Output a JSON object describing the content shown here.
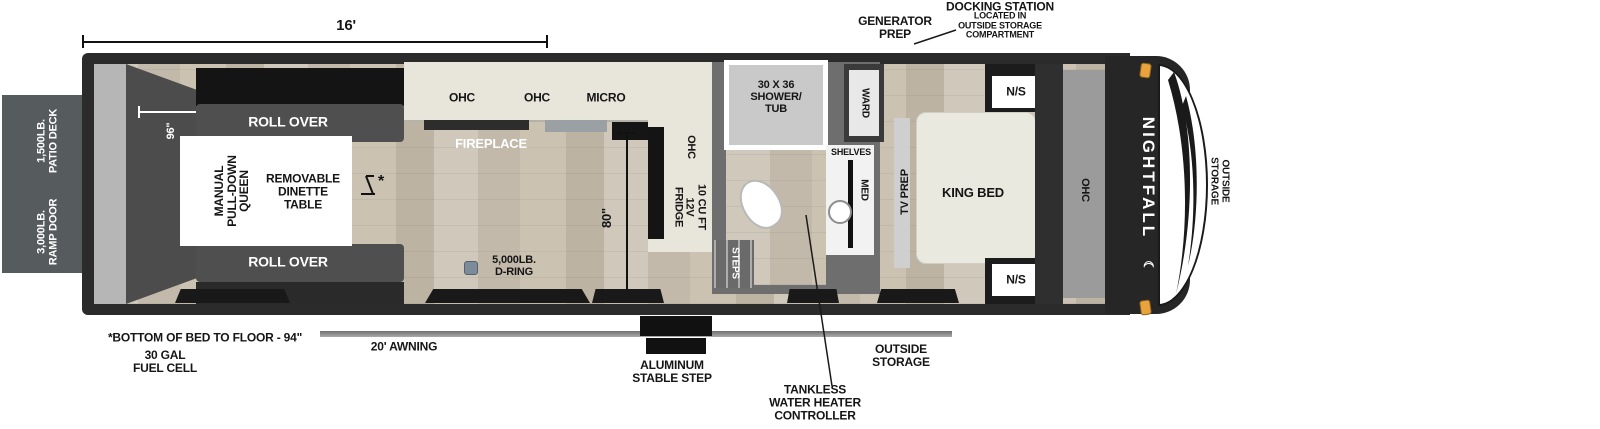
{
  "overall_dim": "16'",
  "exterior_left": {
    "patio_deck": "1,500LB.\nPATIO DECK",
    "ramp_door": "3,000LB.\nRAMP DOOR"
  },
  "garage": {
    "width_dim": "96\"",
    "sofa_top": "ROLL OVER",
    "sofa_bottom": "ROLL OVER",
    "queen_bed": "MANUAL\nPULL-DOWN\nQUEEN",
    "dinette": "REMOVABLE\nDINETTE\nTABLE",
    "table_mark": "*"
  },
  "kitchen": {
    "ohc_left": "OHC",
    "ohc_mid": "OHC",
    "micro": "MICRO",
    "fireplace": "FIREPLACE",
    "ohc_side": "OHC",
    "fridge": "10 CU FT\n12V\nFRIDGE",
    "height_dim": "80\"",
    "d_ring": "5,000LB.\nD-RING"
  },
  "bathroom": {
    "shower": "30 X 36\nSHOWER/\nTUB",
    "shelves": "SHELVES",
    "med": "MED",
    "ward": "WARD",
    "steps": "STEPS"
  },
  "bedroom": {
    "king_bed": "KING BED",
    "tv_prep": "TV PREP",
    "ns_top": "N/S",
    "ns_bottom": "N/S",
    "ohc": "OHC"
  },
  "front": {
    "brand": "NIGHTFALL",
    "crescent": "☾",
    "outside_storage": "OUTSIDE\nSTORAGE"
  },
  "callouts_top": {
    "generator_prep": "GENERATOR\nPREP",
    "docking_station": "DOCKING STATION",
    "docking_station_sub": "LOCATED IN\nOUTSIDE STORAGE\nCOMPARTMENT"
  },
  "callouts_bottom": {
    "bed_to_floor": "*BOTTOM OF BED TO FLOOR - 94\"",
    "fuel_cell": "30 GAL\nFUEL CELL",
    "awning": "20' AWNING",
    "stable_step": "ALUMINUM\nSTABLE STEP",
    "outside_storage": "OUTSIDE\nSTORAGE",
    "tankless": "TANKLESS\nWATER HEATER\nCONTROLLER"
  },
  "colors": {
    "body": "#2b2b2b",
    "counter": "#e8e5da",
    "floor": "#cbc3b6",
    "deck": "#565b5e",
    "marker_light": "#e8a33d"
  }
}
